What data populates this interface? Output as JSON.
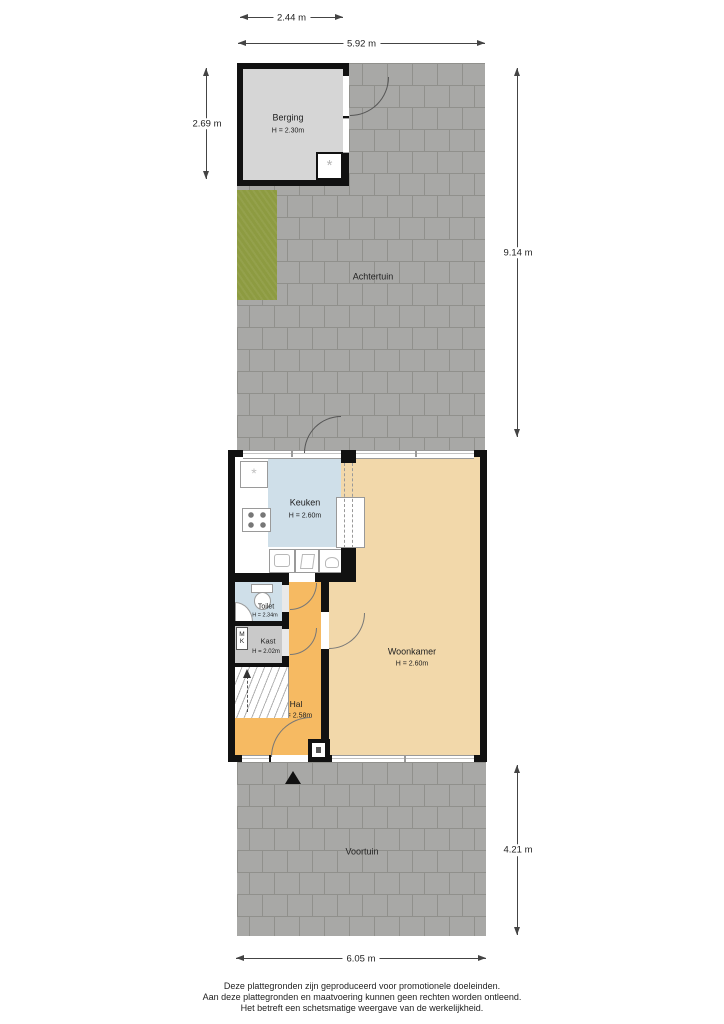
{
  "title": "Floor plan begane grond met tuin",
  "rooms": {
    "berging": {
      "name": "Berging",
      "height": "H = 2.30m"
    },
    "achtertuin": {
      "name": "Achtertuin"
    },
    "keuken": {
      "name": "Keuken",
      "height": "H = 2.60m"
    },
    "woonkamer": {
      "name": "Woonkamer",
      "height": "H = 2.60m"
    },
    "toilet": {
      "name": "Toilet",
      "height": "H = 2.34m"
    },
    "kast": {
      "name": "Kast",
      "height": "H = 2.02m"
    },
    "hal": {
      "name": "Hal",
      "height": "H = 2.58m"
    },
    "voortuin": {
      "name": "Voortuin"
    },
    "meterkast": {
      "line1": "M",
      "line2": "K"
    }
  },
  "dimensions": {
    "berging_width": "2.44 m",
    "plot_width_top": "5.92 m",
    "berging_depth": "2.69 m",
    "achtertuin_depth": "9.14 m",
    "voortuin_depth": "4.21 m",
    "plot_width_bottom": "6.05 m"
  },
  "footer": {
    "line1": "Deze plattegronden zijn geproduceerd voor promotionele doeleinden.",
    "line2": "Aan deze plattegronden en maatvoering kunnen geen rechten worden ontleend.",
    "line3": "Het betreft een schetsmatige weergave van de werkelijkheid."
  },
  "icons": {
    "unit_glyph": "*"
  },
  "colors": {
    "wall": "#111111",
    "pavement": "#a8a8a6",
    "pavement_joint": "#90908c",
    "grass": "#8d9b41",
    "berging_floor": "#d6d6d6",
    "keuken_floor": "#cfdfe9",
    "woonkamer_floor": "#f2d8aa",
    "hal_floor": "#f6ba62",
    "kast_floor": "#c9c9c9",
    "toilet_floor": "#cfdfe9"
  }
}
